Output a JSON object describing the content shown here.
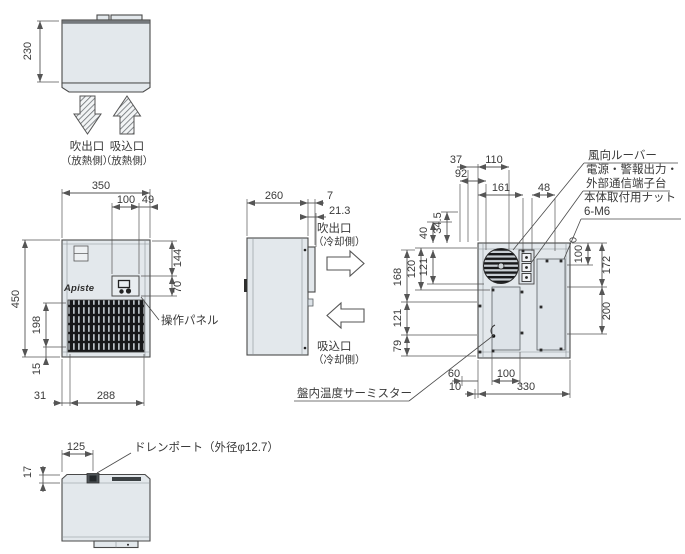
{
  "meta": {
    "type": "technical-dimension-drawing",
    "brand": "Apiste",
    "colors": {
      "body_fill": "#e3e8ec",
      "outline": "#4a4a4a",
      "dim_line": "#555555",
      "grille_dark": "#17181a",
      "text": "#3a3a3a"
    }
  },
  "views": {
    "top": {
      "dim_depth": "230",
      "out_label": "吹出口",
      "out_sub": "（放熱側）",
      "in_label": "吸込口",
      "in_sub": "（放熱側）"
    },
    "front": {
      "brand": "Apiste",
      "dim_width": "350",
      "dim_panel_x": "100",
      "dim_panel_right": "49",
      "dim_height": "450",
      "dim_top_to_panel": "144",
      "dim_panel_h": "70",
      "dim_grille_h": "198",
      "dim_foot": "15",
      "dim_left": "31",
      "dim_grille_w": "288",
      "label_panel": "操作パネル"
    },
    "side": {
      "dim_depth": "260",
      "dim_flange": "7",
      "dim_duct": "21.3",
      "out_label": "吹出口",
      "out_sub": "（冷却側）",
      "in_label": "吸込口",
      "in_sub": "（冷却側）"
    },
    "rear": {
      "dim_37": "37",
      "dim_110": "110",
      "dim_92": "92",
      "dim_161": "161",
      "dim_48": "48",
      "dim_40": "40",
      "dim_34_5": "34.5",
      "dim_120": "120",
      "dim_121a": "121",
      "dim_168": "168",
      "dim_121b": "121",
      "dim_79": "79",
      "dim_100r": "100",
      "dim_172": "172",
      "dim_200": "200",
      "dim_60": "60",
      "dim_10": "10",
      "dim_100b": "100",
      "dim_330": "330",
      "label_louver": "風向ルーバー",
      "label_terminal1": "電源・警報出力・",
      "label_terminal2": "外部通信端子台",
      "label_nut1": "本体取付用ナット",
      "label_nut2": "6-M6",
      "label_thermistor": "盤内温度サーミスター"
    },
    "bottom": {
      "dim_125": "125",
      "dim_17": "17",
      "label_drain": "ドレンポート（外径φ12.7）"
    }
  }
}
